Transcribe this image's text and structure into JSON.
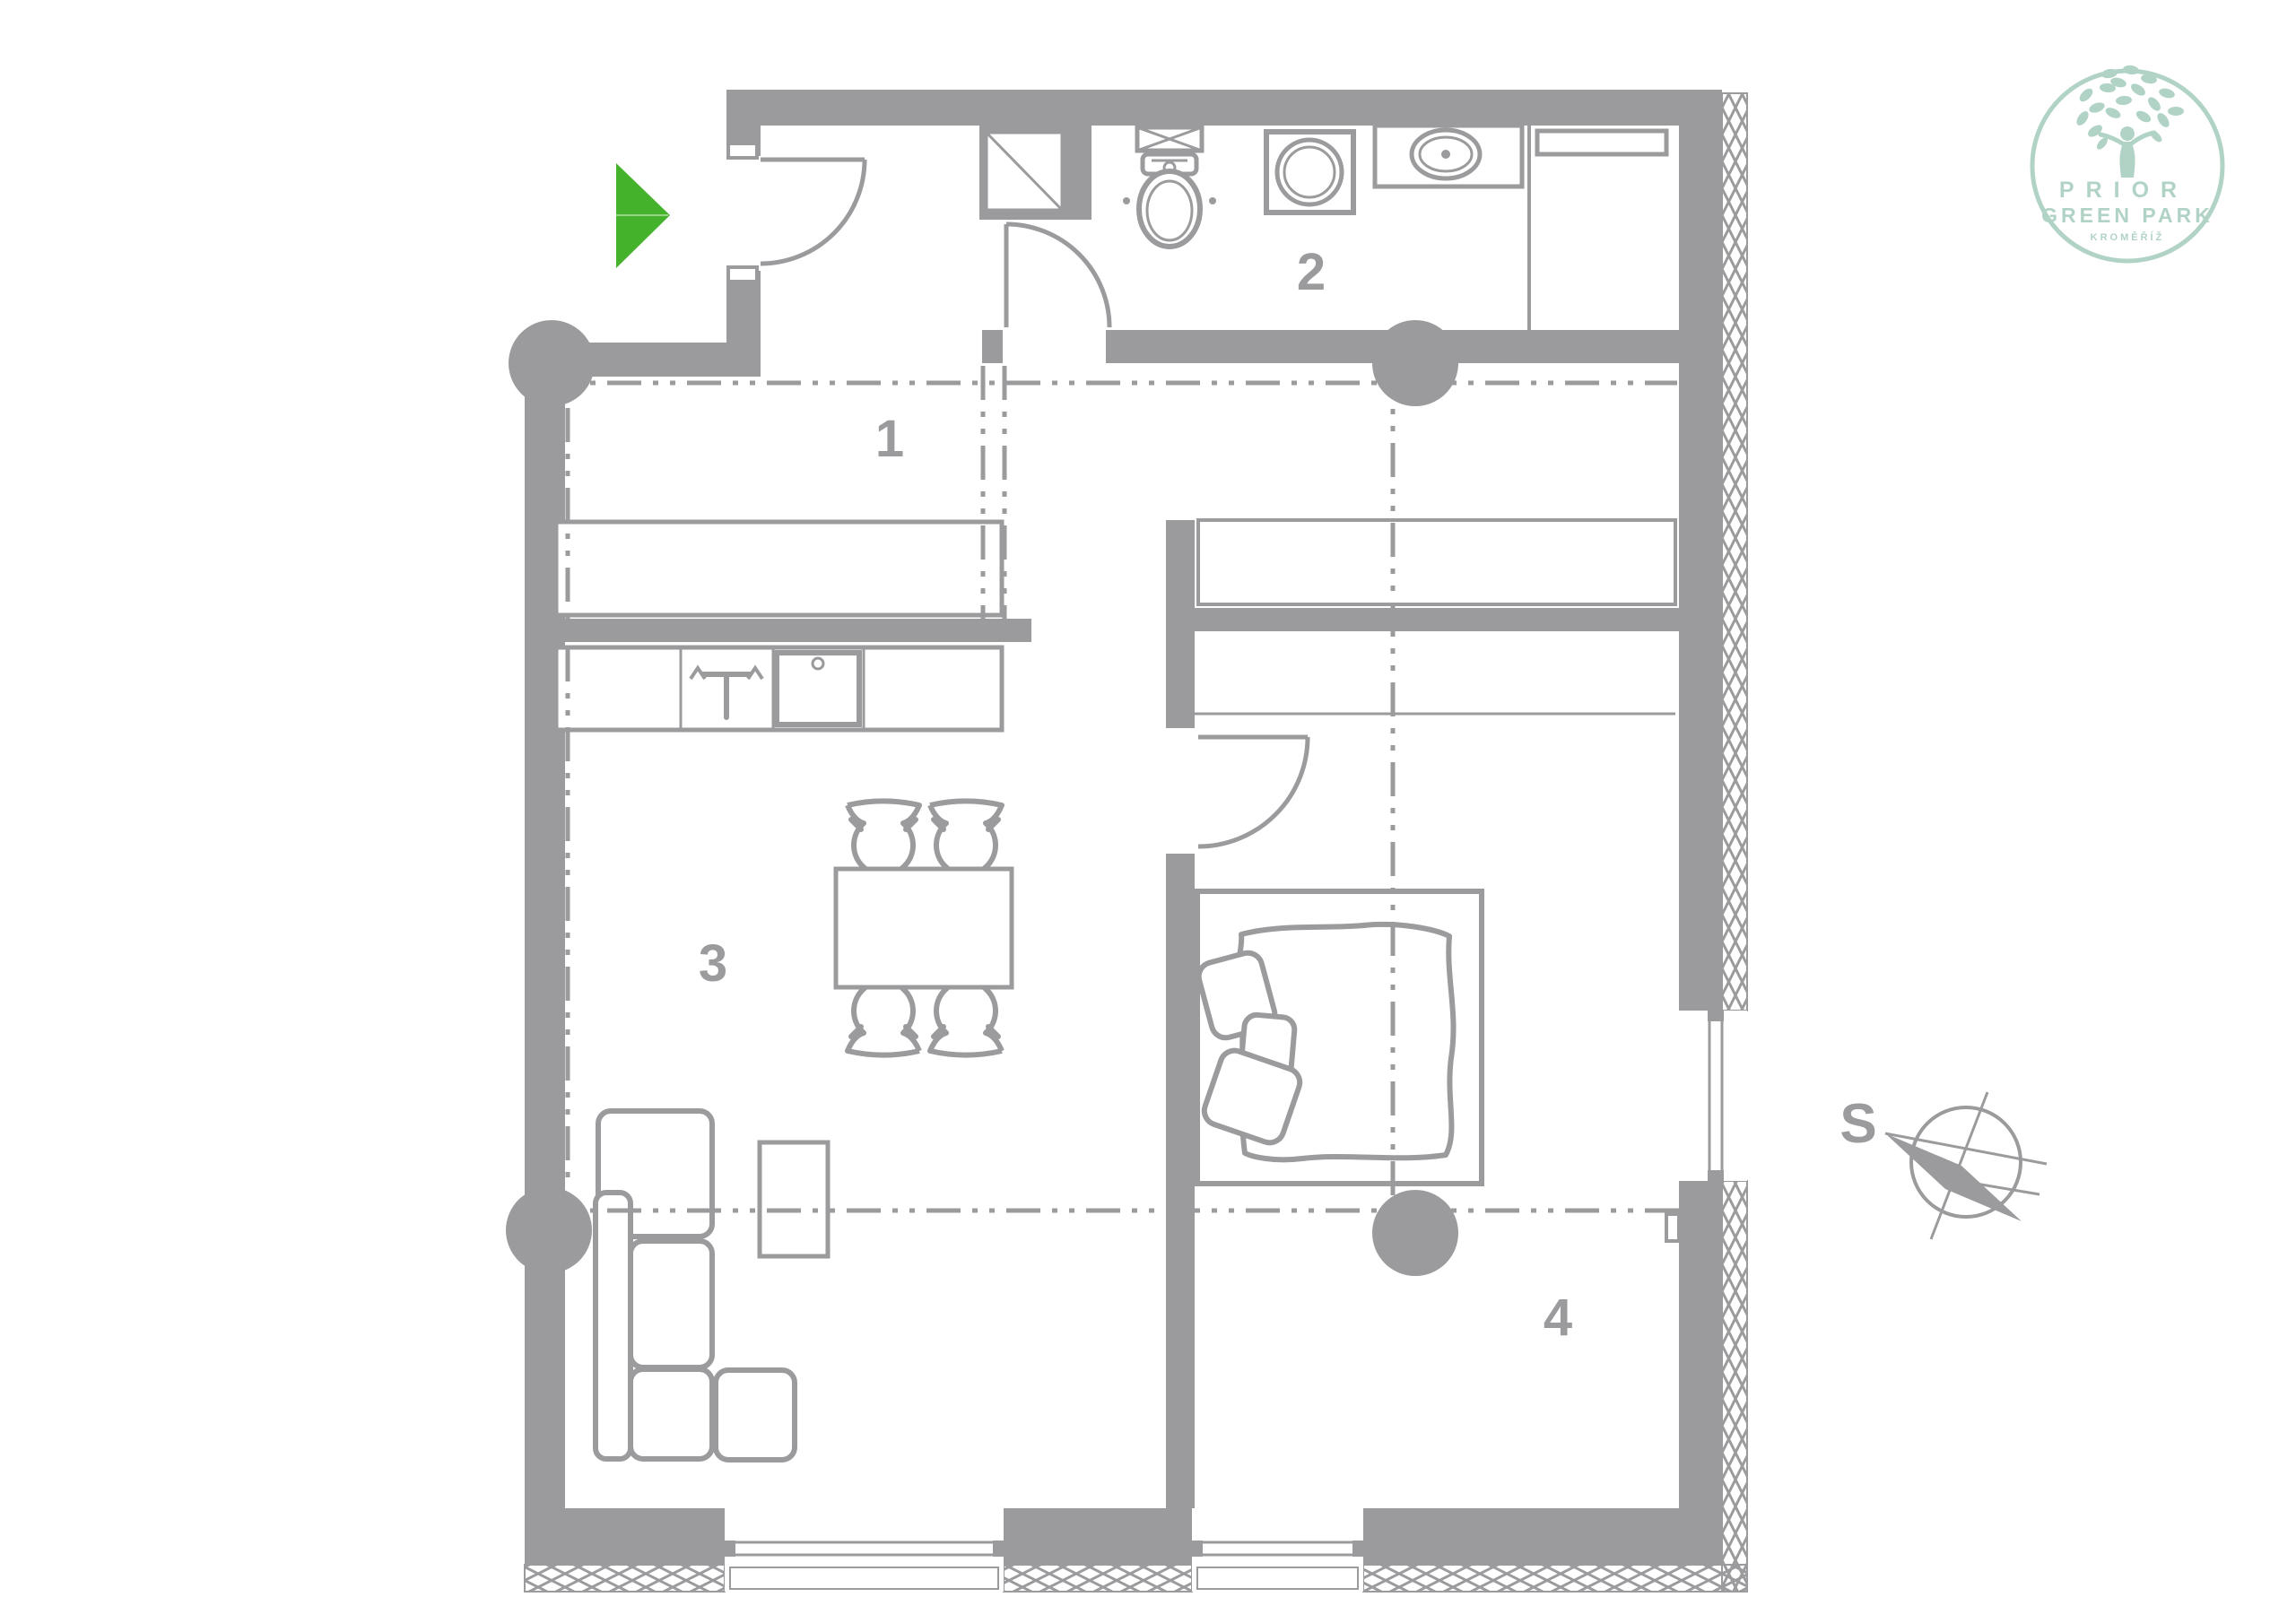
{
  "colors": {
    "wall": "#9b9b9e",
    "green": "#45b22c",
    "mint": "#b1d3c5",
    "background": "#ffffff"
  },
  "rooms": [
    {
      "label": "1"
    },
    {
      "label": "2"
    },
    {
      "label": "3"
    },
    {
      "label": "4"
    }
  ],
  "compass": {
    "south": "S"
  },
  "logo": {
    "brand": "PRIOR",
    "subbrand": "GREEN PARK",
    "city": "KROMĚŘÍŽ"
  },
  "icons": {
    "entrance_arrow": "triangle-right",
    "compass_needle": "diamond-needle",
    "logo_tree": "tree"
  }
}
